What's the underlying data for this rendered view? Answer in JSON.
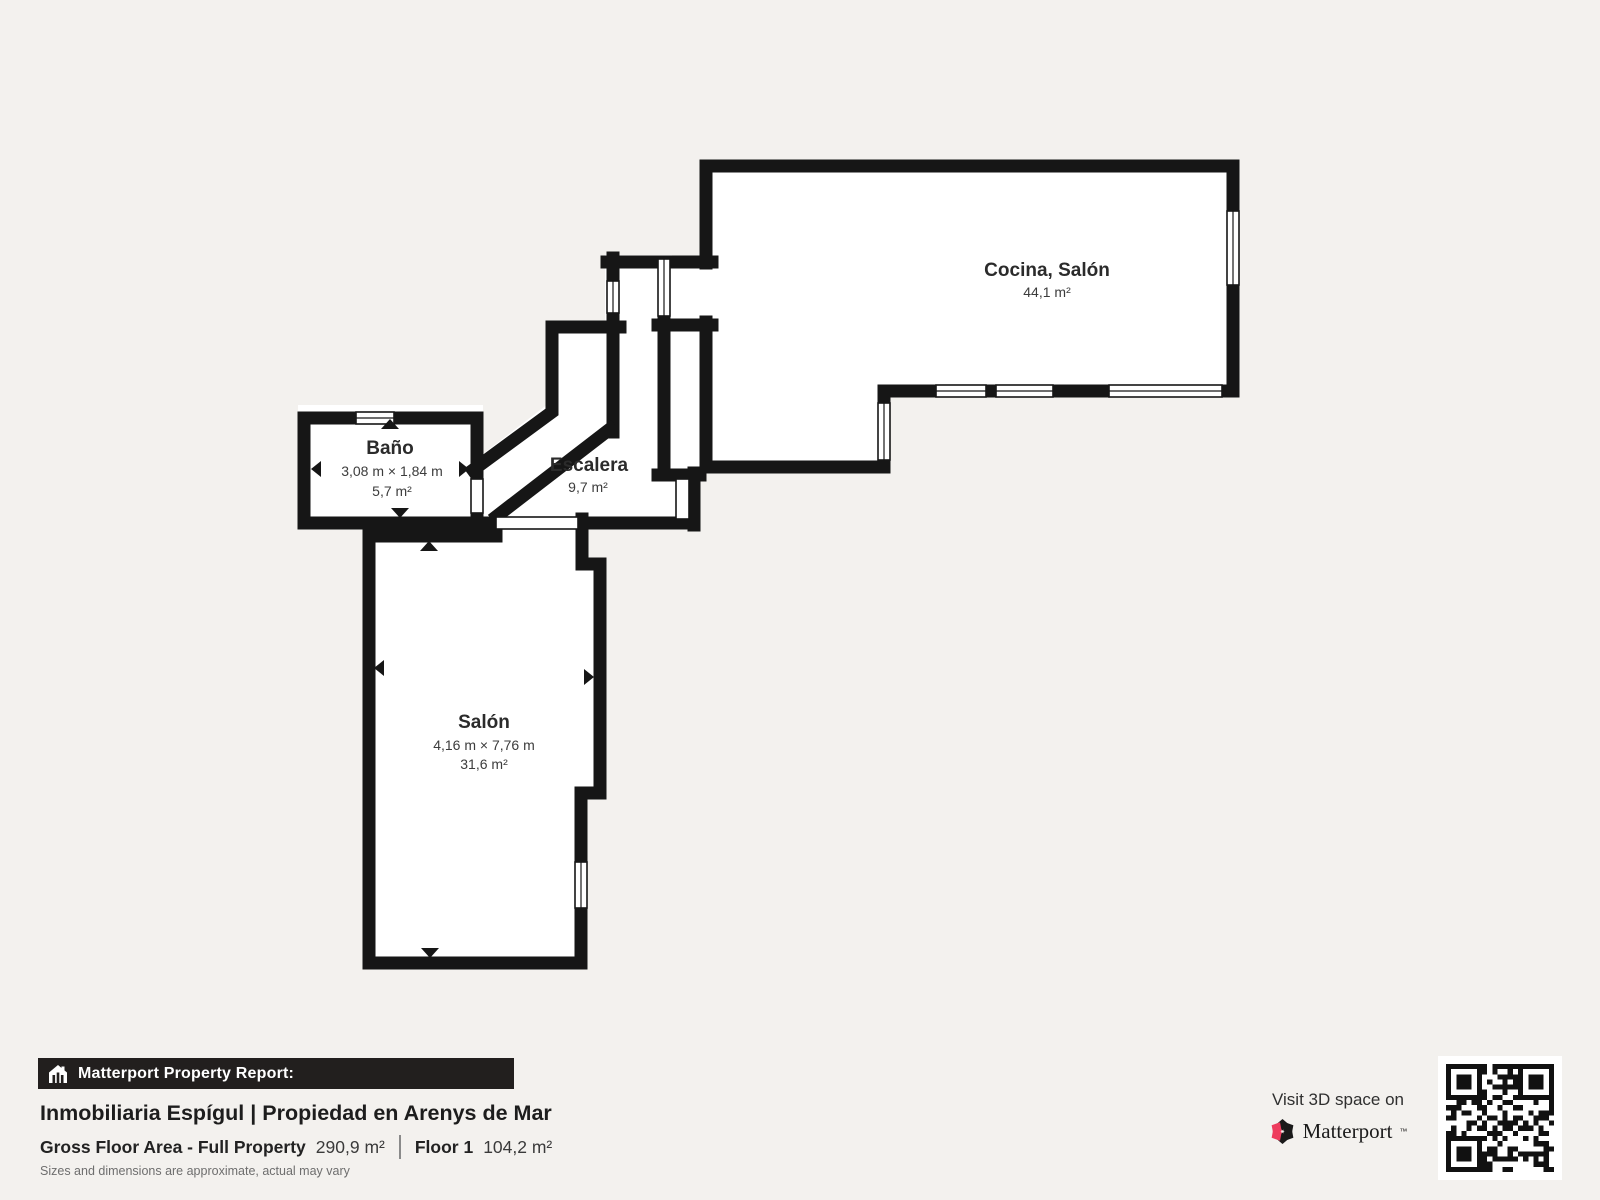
{
  "rooms": {
    "cocina": {
      "name": "Cocina, Salón",
      "area": "44,1 m²"
    },
    "bano": {
      "name": "Baño",
      "dimensions": "3,08 m × 1,84 m",
      "area": "5,7 m²"
    },
    "escalera": {
      "name": "Escalera",
      "area": "9,7 m²"
    },
    "salon": {
      "name": "Salón",
      "dimensions": "4,16 m × 7,76 m",
      "area": "31,6 m²"
    }
  },
  "report": {
    "banner_label": "Matterport Property Report:",
    "title": "Inmobiliaria Espígul | Propiedad en Arenys de Mar",
    "gross_floor_area_label": "Gross Floor Area - Full Property",
    "gross_floor_area_value": "290,9 m²",
    "floor_label": "Floor 1",
    "floor_value": "104,2 m²",
    "disclaimer": "Sizes and dimensions are approximate, actual may vary"
  },
  "cta": {
    "visit_label": "Visit 3D space on",
    "brand": "Matterport",
    "trademark": "™"
  },
  "icons": [
    "house-report-icon",
    "matterport-pinwheel-icon",
    "qr-code",
    "dimension-arrows"
  ],
  "colors": {
    "background": "#f3f1ee",
    "wall": "#161616",
    "room_fill": "#ffffff",
    "banner_bg": "#221f1e",
    "brand_pink": "#ee3c5d"
  }
}
